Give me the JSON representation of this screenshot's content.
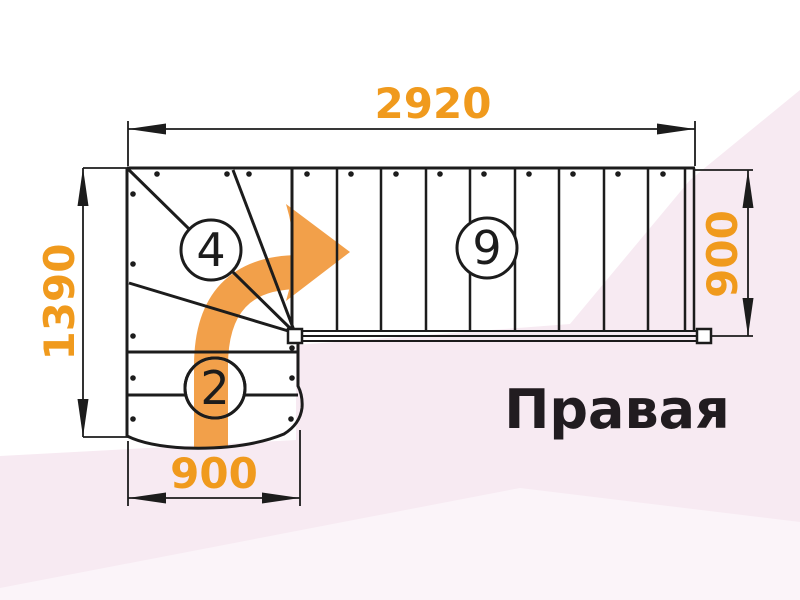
{
  "title": "Правая",
  "dimensions": {
    "total_length_mm": "2920",
    "left_depth_mm": "1390",
    "right_width_mm": "900",
    "bottom_width_mm": "900"
  },
  "steps": {
    "winder_flight_count": "4",
    "straight_flight_count": "9",
    "bottom_flight_count": "2"
  },
  "icons": {
    "direction_arrow": "curved-right-turn-arrow"
  },
  "colors": {
    "dimension_text_orange": "#F09A1D",
    "arrow_orange": "#F2A04A",
    "line_color": "#1C1C1C",
    "background_pink": "#F7EAF2",
    "background_pink_light": "#FBF4F9"
  }
}
